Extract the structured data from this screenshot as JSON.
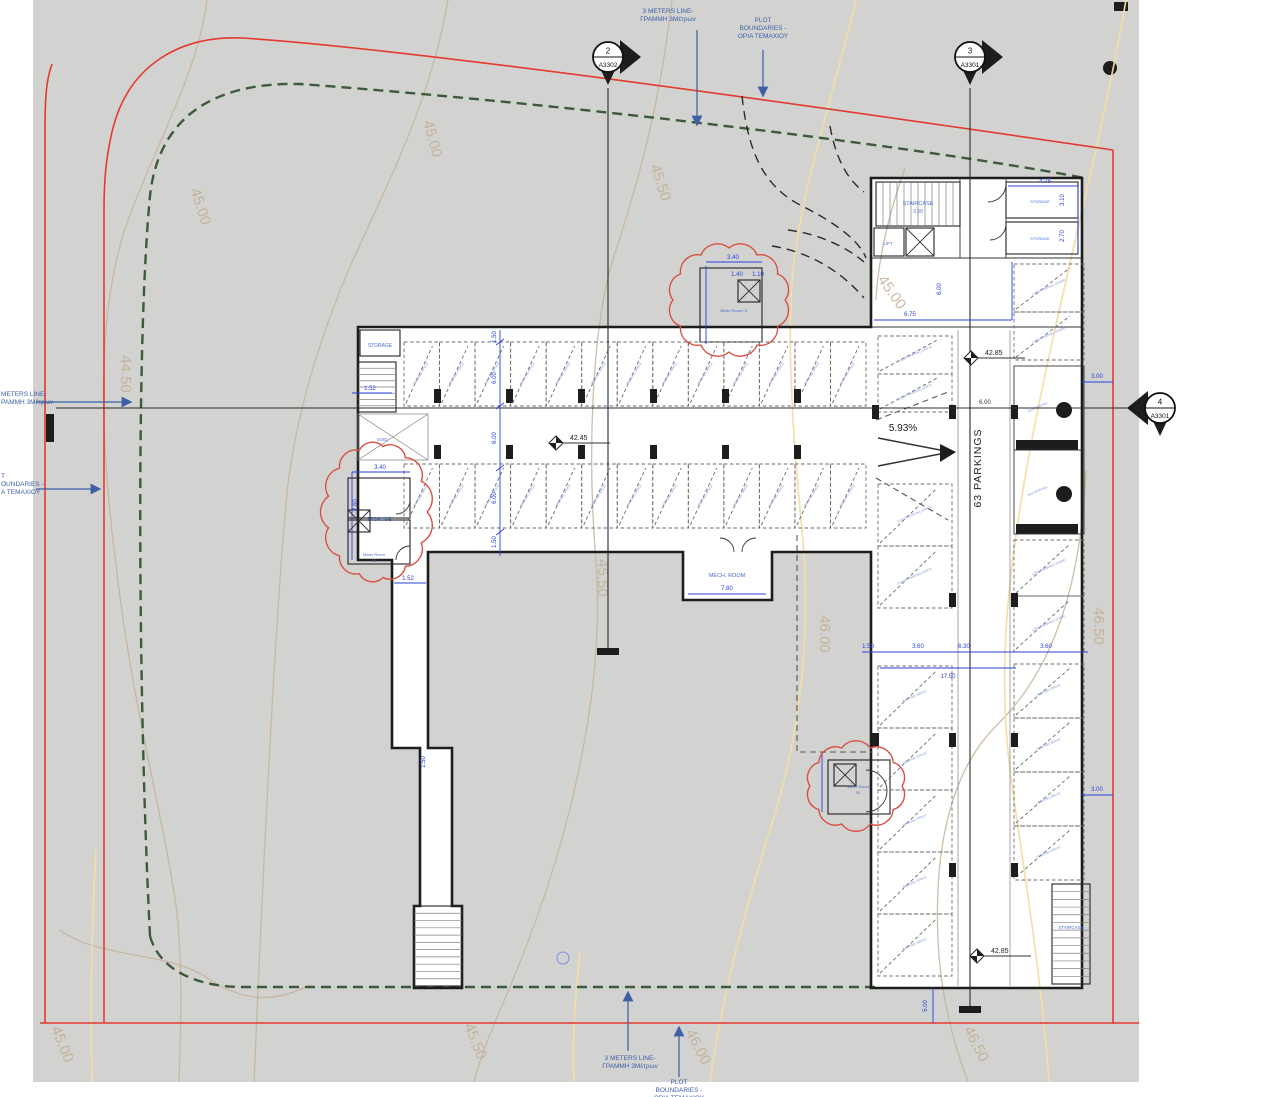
{
  "drawing": {
    "type": "basement parking site plan",
    "parking_total_label": "63 PARKINGS",
    "ramp_slope": "5.93%"
  },
  "colors": {
    "sheet": "#d2d2d1",
    "plot_boundary_red": "#e23b2e",
    "meters_line_green": "#3d5a3a",
    "dimension_blue": "#2742de",
    "cad_text_blue": "#4a6fd0",
    "stall_text_blue": "#7d95da",
    "callout_blue": "#3c5fa6",
    "contour_tan": "#c3ad90",
    "contour_yellow": "#f0dfa3",
    "wall_black": "#1d1d1d"
  },
  "callouts": [
    {
      "id": "top-meters",
      "lines": [
        "3 METERS  LINE-",
        "ΓΡΑΜΜΗ 3Μέτρων"
      ],
      "tx": 668,
      "ty": 13,
      "anchor": "middle",
      "arrow": [
        697,
        30,
        697,
        124
      ]
    },
    {
      "id": "top-plot",
      "lines": [
        "PLOT",
        "BOUNDARIES -",
        "ΟΡΙΑ ΤΕΜΑΧΙΟΥ"
      ],
      "tx": 763,
      "ty": 22,
      "anchor": "middle",
      "arrow": [
        763,
        50,
        763,
        95
      ]
    },
    {
      "id": "left-meters",
      "lines": [
        "METERS  LINE-",
        "ΡΑΜΜΗ 3Μέτρων"
      ],
      "tx": 1,
      "ty": 396,
      "anchor": "start",
      "arrow": [
        36,
        402,
        130,
        402
      ]
    },
    {
      "id": "left-plot",
      "lines": [
        "T",
        "OUNDARIES -",
        "A ΤΕΜΑΧΙΟΥ"
      ],
      "tx": 1,
      "ty": 478,
      "anchor": "start",
      "arrow": [
        36,
        489,
        99,
        489
      ]
    },
    {
      "id": "bottom-meters",
      "lines": [
        "3 METERS  LINE-",
        "ΓΡΑΜΜΗ 3Μέτρων"
      ],
      "tx": 630,
      "ty": 1060,
      "anchor": "middle",
      "arrow": [
        628,
        1051,
        628,
        993
      ]
    },
    {
      "id": "bottom-plot",
      "lines": [
        "PLOT",
        "BOUNDARIES -",
        "ΟΡΙΑ ΤΕΜΑΧΙΟΥ"
      ],
      "tx": 679,
      "ty": 1084,
      "anchor": "middle",
      "arrow": [
        679,
        1077,
        679,
        1028
      ]
    }
  ],
  "section_markers": [
    {
      "num": "2",
      "sheet": "A3302",
      "x": 608,
      "y": 57,
      "side": "right"
    },
    {
      "num": "3",
      "sheet": "A3301",
      "x": 970,
      "y": 57,
      "side": "right"
    },
    {
      "num": "4",
      "sheet": "A3301",
      "x": 1160,
      "y": 408,
      "side": "left"
    }
  ],
  "levels": [
    {
      "v": "42.45",
      "x": 556,
      "y": 443
    },
    {
      "v": "42.85",
      "x": 971,
      "y": 358
    },
    {
      "v": "42.85",
      "x": 977,
      "y": 956
    }
  ],
  "dimensions": [
    {
      "v": "6.75",
      "x": 910,
      "y": 316
    },
    {
      "v": "6.00",
      "x": 941,
      "y": 289,
      "r": -90
    },
    {
      "v": "4.75",
      "x": 1045,
      "y": 183
    },
    {
      "v": "3.10",
      "x": 1064,
      "y": 200,
      "r": -90
    },
    {
      "v": "2.70",
      "x": 1064,
      "y": 236,
      "r": -90
    },
    {
      "v": "3.40",
      "x": 733,
      "y": 259
    },
    {
      "v": "1.40",
      "x": 737,
      "y": 276
    },
    {
      "v": "1.10",
      "x": 758,
      "y": 276
    },
    {
      "v": "3.40",
      "x": 380,
      "y": 469
    },
    {
      "v": "2.60",
      "x": 357,
      "y": 505,
      "r": -90
    },
    {
      "v": "7.80",
      "x": 727,
      "y": 590
    },
    {
      "v": "1.52",
      "x": 370,
      "y": 390
    },
    {
      "v": "1.52",
      "x": 408,
      "y": 580
    },
    {
      "v": "1.50",
      "x": 425,
      "y": 762,
      "r": -90
    },
    {
      "v": "1.50",
      "x": 496,
      "y": 337,
      "r": -90
    },
    {
      "v": "6.00",
      "x": 496,
      "y": 378,
      "r": -90
    },
    {
      "v": "6.00",
      "x": 496,
      "y": 438,
      "r": -90
    },
    {
      "v": "6.00",
      "x": 496,
      "y": 498,
      "r": -90
    },
    {
      "v": "1.50",
      "x": 496,
      "y": 542,
      "r": -90
    },
    {
      "v": "3.00",
      "x": 1097,
      "y": 378
    },
    {
      "v": "3.00",
      "x": 1097,
      "y": 791
    },
    {
      "v": "1.50",
      "x": 868,
      "y": 648
    },
    {
      "v": "3.60",
      "x": 918,
      "y": 648
    },
    {
      "v": "6.30",
      "x": 964,
      "y": 648
    },
    {
      "v": "3.60",
      "x": 1046,
      "y": 648
    },
    {
      "v": "17.50",
      "x": 948,
      "y": 678
    },
    {
      "v": "5.00",
      "x": 927,
      "y": 1006,
      "r": -90
    }
  ],
  "contour_labels": [
    {
      "v": "44.50",
      "x": 121,
      "y": 374,
      "r": 90
    },
    {
      "v": "45.00",
      "x": 196,
      "y": 208,
      "r": 72
    },
    {
      "v": "45.00",
      "x": 428,
      "y": 140,
      "r": 75
    },
    {
      "v": "45.50",
      "x": 656,
      "y": 184,
      "r": 72
    },
    {
      "v": "45.00",
      "x": 888,
      "y": 295,
      "r": 55
    },
    {
      "v": "45.50",
      "x": 598,
      "y": 578,
      "r": 90
    },
    {
      "v": "46.00",
      "x": 820,
      "y": 634,
      "r": 90
    },
    {
      "v": "46.50",
      "x": 1094,
      "y": 626,
      "r": 90
    },
    {
      "v": "45.00",
      "x": 58,
      "y": 1046,
      "r": 68
    },
    {
      "v": "45.50",
      "x": 471,
      "y": 1043,
      "r": 68
    },
    {
      "v": "46.00",
      "x": 694,
      "y": 1049,
      "r": 63
    },
    {
      "v": "46.50",
      "x": 972,
      "y": 1046,
      "r": 63
    }
  ],
  "labels": [
    {
      "t": "STORAGE",
      "x": 380,
      "y": 347,
      "s": 5
    },
    {
      "t": "VOID",
      "x": 382,
      "y": 441,
      "s": 4.5
    },
    {
      "t": "STAIRCASE",
      "x": 918,
      "y": 205,
      "s": 5.5
    },
    {
      "t": "3.50",
      "x": 918,
      "y": 213,
      "s": 5
    },
    {
      "t": "LIFT",
      "x": 888,
      "y": 245,
      "s": 4.5
    },
    {
      "t": "STORAGE",
      "x": 1040,
      "y": 203,
      "s": 4
    },
    {
      "t": "STORAGE",
      "x": 1040,
      "y": 240,
      "s": 4
    },
    {
      "t": "MECH. ROOM",
      "x": 727,
      "y": 577,
      "s": 5.5
    },
    {
      "t": "STORAGE",
      "x": 379,
      "y": 521,
      "s": 5
    },
    {
      "t": "Meter Room",
      "x": 374,
      "y": 556,
      "s": 4
    },
    {
      "t": "02",
      "x": 374,
      "y": 562,
      "s": 4
    },
    {
      "t": "Meter Room 01",
      "x": 734,
      "y": 312,
      "s": 4
    },
    {
      "t": "Meter Room",
      "x": 858,
      "y": 788,
      "s": 4
    },
    {
      "t": "03",
      "x": 858,
      "y": 794,
      "s": 4
    },
    {
      "t": "STAIRCASE",
      "x": 1071,
      "y": 929,
      "s": 4.5
    },
    {
      "t": "63 PARKINGS",
      "x": 981,
      "y": 468,
      "s": 10.5,
      "r": -90,
      "c": "#222",
      "ls": 1
    },
    {
      "t": "5.93%",
      "x": 903,
      "y": 431,
      "s": 10,
      "c": "#222"
    },
    {
      "t": "6.00",
      "x": 985,
      "y": 404,
      "s": 6,
      "c": "#333"
    }
  ],
  "parking": {
    "rows": [
      {
        "x": 404,
        "y": 342,
        "w": 462,
        "h": 64,
        "count": 13,
        "o": "h",
        "label": "PARKING SPACE"
      },
      {
        "x": 404,
        "y": 464,
        "w": 462,
        "h": 64,
        "count": 13,
        "o": "h",
        "label": "PARKING SPACE"
      },
      {
        "x": 878,
        "y": 336,
        "w": 74,
        "h": 38,
        "count": 2,
        "o": "v",
        "label": "GUEST PARKING SPACE"
      },
      {
        "x": 878,
        "y": 484,
        "w": 74,
        "h": 62,
        "count": 2,
        "o": "v",
        "label": "GUEST PARKING SPACE"
      },
      {
        "x": 1014,
        "y": 264,
        "w": 70,
        "h": 48,
        "count": 2,
        "o": "v",
        "label": "LONG PARKING ΟΧΗΜΑ"
      },
      {
        "x": 1014,
        "y": 540,
        "w": 70,
        "h": 56,
        "count": 2,
        "o": "v",
        "label": "LONG PARKING ΟΧΗΜΑ"
      },
      {
        "x": 1014,
        "y": 664,
        "w": 70,
        "h": 54,
        "count": 4,
        "o": "v",
        "label": "PARKING SPACE"
      },
      {
        "x": 878,
        "y": 666,
        "w": 74,
        "h": 62,
        "count": 5,
        "o": "v",
        "label": "PARKING SPACE"
      }
    ],
    "dda": {
      "x": 1014,
      "y": 366,
      "w": 70,
      "h": 84,
      "count": 2,
      "label": "DDA PARKING"
    }
  }
}
